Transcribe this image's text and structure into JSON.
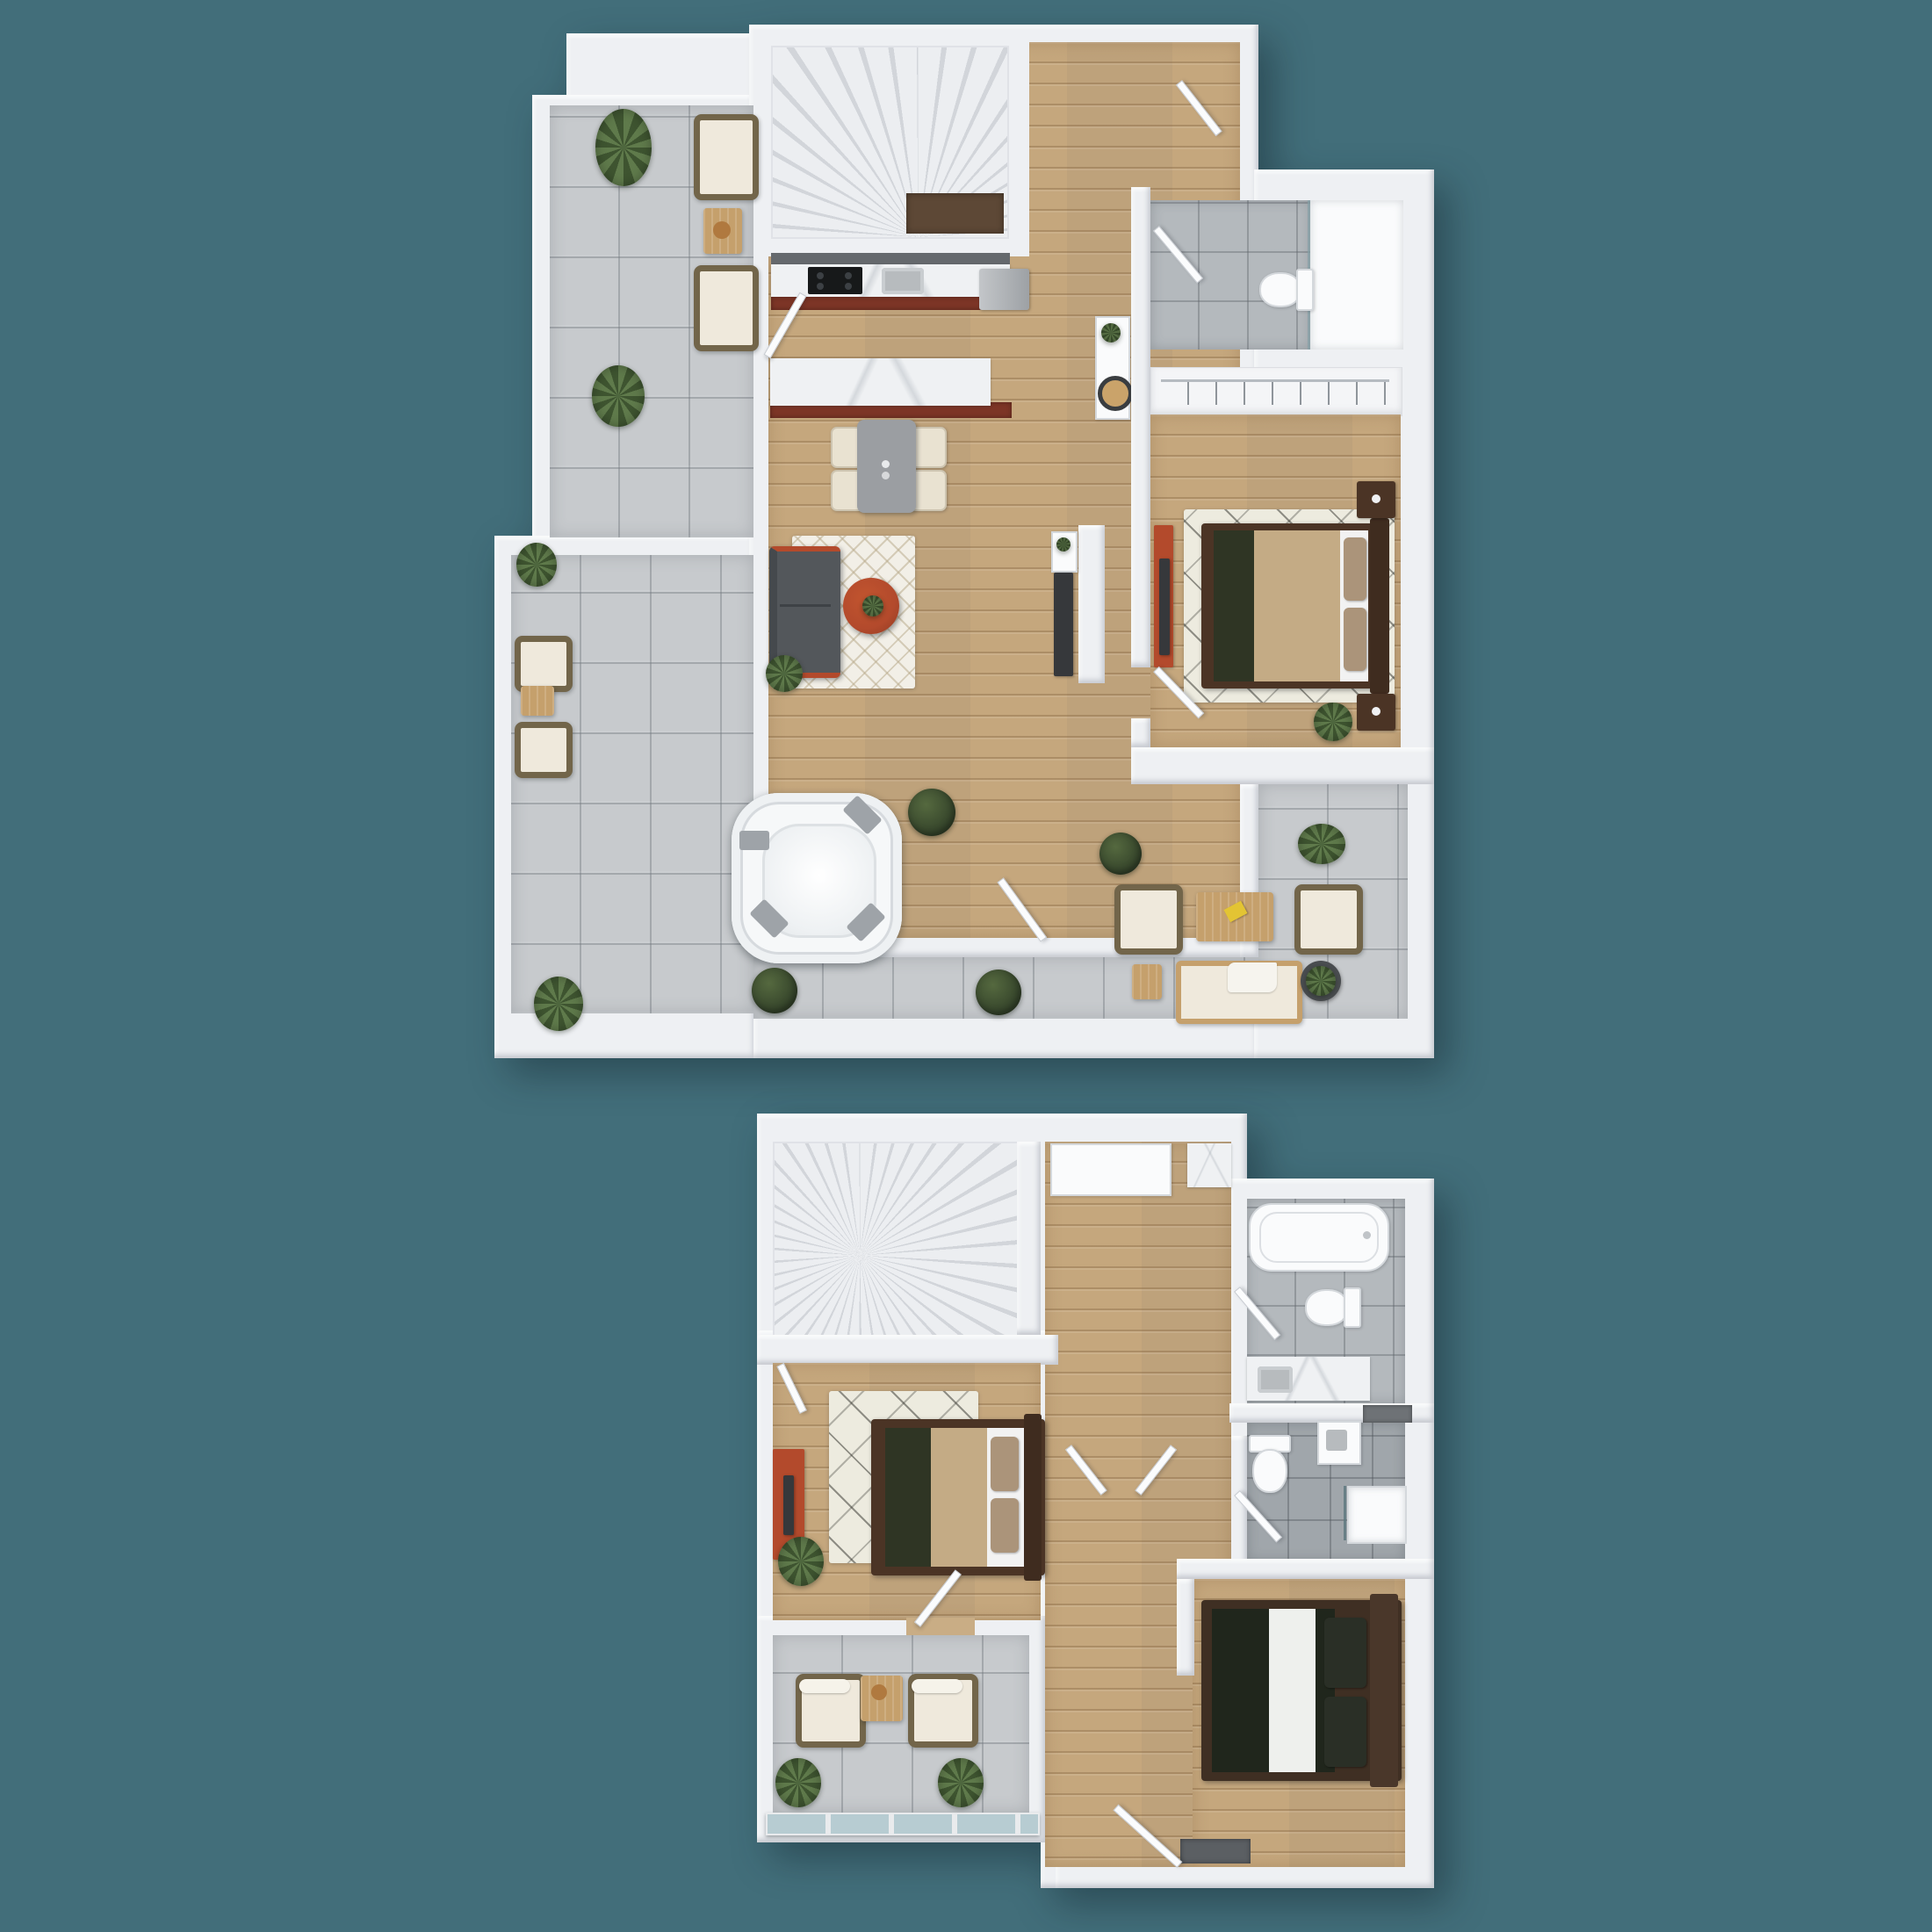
{
  "scene": {
    "description": "3D top-down architectural render of a two-storey apartment, two floor plans stacked vertically on a teal background",
    "floor_count": 2,
    "visible_text": "none"
  },
  "palette": {
    "background": "#426e7a",
    "wall": "#eef0f3",
    "tile": "#c7cacd",
    "tileLine": "rgba(120,126,132,0.45)",
    "wood": "#c9ad85",
    "bathTileA": "#b4b9bd",
    "bathTileB": "#a0a6ab",
    "marble": "#eff1f3",
    "marbleVein": "rgba(168,175,183,0.38)",
    "cabinetRed": "#7c3526",
    "steel": "#b7bbbe",
    "cooktop": "#17191a",
    "tableGray": "#9b9ea2",
    "chairCream": "#e9e2d1",
    "sofaGray": "#53575b",
    "accentOrange": "#b34a2c",
    "rugBase": "#f2efe7",
    "berberBase": "#edebdf",
    "bedFrame": "#4b3425",
    "blanketTan": "#c4ab85",
    "runnerGreen": "#2f3524",
    "pillowTan": "#ab947a",
    "sheetWhite": "#f2f2f2",
    "duvetDark": "#20261c",
    "pillowDark": "#2a2f26",
    "wicker": "#72654a",
    "cushion": "#efe9dc",
    "outdoorWood": "#c5a06c",
    "plantA": "#5f7a4b",
    "plantB": "#3e5430",
    "boxA": "#55693f",
    "boxB": "#34432a",
    "stairA": "#eceef1",
    "stairB": "#d2d5da",
    "landing": "#5d4836",
    "tvDark": "#36383b",
    "mat": "#5b5f63",
    "glassRail": "#b7ccd2",
    "doorLeaf": "#fbfcfd",
    "fixtureWhite": "#fafbfc",
    "fixtureEdge": "#d4d8dc",
    "hotTub": "#f6f8f9",
    "hotTubPad": "#9ea3a8"
  },
  "floors": [
    {
      "id": "upper-plan",
      "name": "Level 1 - living level with wrap-around terrace",
      "rooms": [
        {
          "id": "terrace",
          "name": "Terrace",
          "floor_material": "concrete tiles",
          "furniture": [
            "hot tub with 4 gray headrest pads",
            "2 wicker lounge chairs + side table (top)",
            "2 wicker lounge chairs + side table (left)",
            "2 outdoor armchairs",
            "outdoor coffee table with yellow book",
            "outdoor sofa with throw",
            "side table",
            "potted plant in round planter",
            "4 leafy plants",
            "4 boxwood shrubs",
            "palm plant"
          ]
        },
        {
          "id": "staircase",
          "name": "Staircase",
          "floor_material": "white treads",
          "furniture": [
            "winder staircase",
            "dark landing cabinet"
          ]
        },
        {
          "id": "kitchen",
          "name": "Kitchen",
          "floor_material": "wood planks",
          "furniture": [
            "marble wall counter",
            "black cooktop",
            "stainless sink",
            "red-brown cabinet fronts",
            "stainless fridge",
            "marble island with red-brown base",
            "entry door"
          ]
        },
        {
          "id": "dining",
          "name": "Dining area",
          "floor_material": "wood planks",
          "furniture": [
            "gray dining table",
            "4 cream chairs",
            "table-top set"
          ]
        },
        {
          "id": "living",
          "name": "Living area",
          "floor_material": "wood planks",
          "furniture": [
            "dark gray sofa with orange trim",
            "white trellis rug",
            "round orange coffee table with plant",
            "corner plant",
            "TV cabinet",
            "white media shelf with plant",
            "partial TV wall"
          ]
        },
        {
          "id": "hallway",
          "name": "Hallway / entry",
          "floor_material": "wood planks",
          "furniture": [
            "white console table",
            "plant",
            "round black decor",
            "terrace doors",
            "entry door"
          ]
        },
        {
          "id": "bathroom",
          "name": "Bathroom",
          "floor_material": "gray tiles",
          "furniture": [
            "walk-in shower with glass screen",
            "toilet",
            "door"
          ]
        },
        {
          "id": "closet",
          "name": "Wardrobe nook",
          "floor_material": "white",
          "furniture": [
            "open wardrobe with hanging rail and hangers"
          ]
        },
        {
          "id": "bedroom",
          "name": "Bedroom",
          "floor_material": "wood planks",
          "furniture": [
            "double bed with tan duvet and green runner",
            "brown headboard",
            "2 dark nightstands with lamps",
            "berber rug",
            "red media board with TV",
            "plant",
            "door"
          ]
        }
      ]
    },
    {
      "id": "lower-plan",
      "name": "Level 2 - bedroom level with balcony",
      "rooms": [
        {
          "id": "stair-hall",
          "name": "Staircase hall",
          "floor_material": "wood planks",
          "furniture": [
            "winder staircase",
            "white wardrobe cabinet",
            "marble counter corner",
            "double hall doors"
          ]
        },
        {
          "id": "master-bedroom",
          "name": "Master bedroom",
          "floor_material": "wood planks",
          "furniture": [
            "double bed with tan duvet and green runner",
            "brown headboard",
            "berber rug",
            "red dresser with TV",
            "plant",
            "balcony door",
            "window"
          ]
        },
        {
          "id": "balcony",
          "name": "Balcony",
          "floor_material": "concrete tiles",
          "furniture": [
            "2 wicker armchairs",
            "wood side table with tray",
            "2 leafy plants",
            "glass railing"
          ]
        },
        {
          "id": "bathroom-1",
          "name": "Bathroom 1",
          "floor_material": "gray tiles",
          "furniture": [
            "bathtub",
            "toilet",
            "marble vanity with sink",
            "door"
          ]
        },
        {
          "id": "bathroom-2",
          "name": "Bathroom 2",
          "floor_material": "dark gray tiles",
          "furniture": [
            "toilet",
            "vanity cabinet with sink",
            "walk-in shower with glass",
            "wall niche",
            "door"
          ]
        },
        {
          "id": "bedroom-2",
          "name": "Bedroom 2",
          "floor_material": "wood planks",
          "furniture": [
            "double bed with dark duvet and white runner",
            "2 dark pillows",
            "brown headboard",
            "dark doormat",
            "door"
          ]
        }
      ]
    }
  ]
}
